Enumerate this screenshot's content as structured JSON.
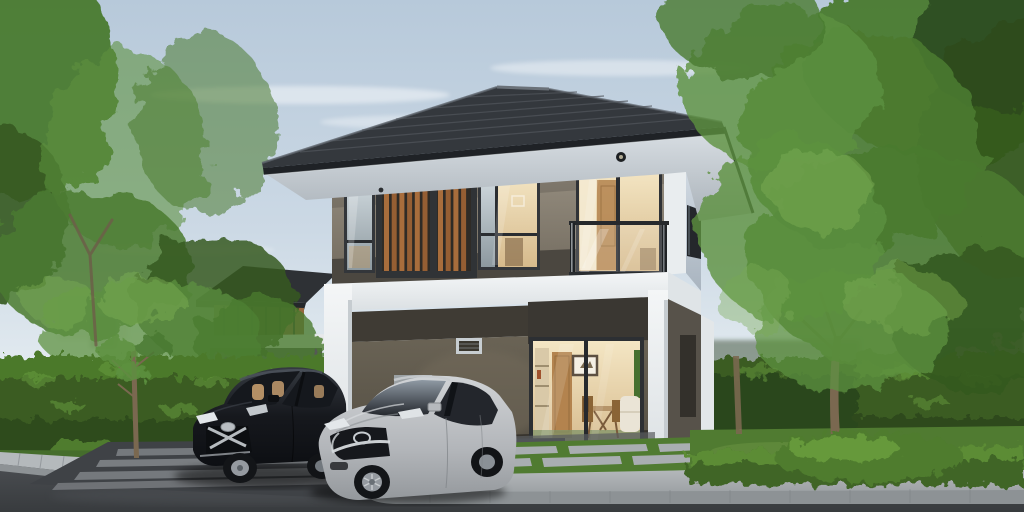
{
  "meta": {
    "kind": "architectural-exterior-render",
    "subject": "modern two-story detached house with carport, two parked cars, hedges, lawn and trees",
    "objects": [
      "sky",
      "clouds",
      "left-trees",
      "right-trees",
      "neighbor-house",
      "left-hedge",
      "right-hedge",
      "low-hedge",
      "lawn",
      "main-house",
      "hip-roof",
      "soffit-downlight",
      "wood-slat-panel",
      "balcony-glass-railing",
      "sliding-glass-door",
      "carport",
      "vent-window",
      "black-hatchback-car",
      "silver-sedan-car",
      "striped-driveway",
      "sidewalk",
      "curb",
      "road",
      "stepping-stones",
      "tree-trunks",
      "garden-bush"
    ]
  },
  "palette": {
    "sky_top": "#b7c9da",
    "sky_horizon": "#ecf1f4",
    "cloud": "#ffffff",
    "foliage": {
      "dark": "#2c4a1e",
      "deep": "#35591f",
      "mid": "#4a7a30",
      "light": "#5d9140",
      "bright": "#79ab52",
      "trunk": "#7a6850"
    },
    "hedge": {
      "base": "#3a5c23",
      "top": "#4f7c2e",
      "shadow": "#2c471c",
      "speckle": "#6ba03f",
      "low": "#3f6526",
      "low_top": "#5c8c35"
    },
    "lawn": {
      "base": "#507b31",
      "light": "#699442",
      "strip": "#456d2c"
    },
    "house": {
      "roof": "#34383d",
      "roof_line": "#50555b",
      "ridge": "#6a7178",
      "fascia": "#1f2226",
      "wall_top": "#948c7e",
      "wall_bottom": "#6f685c",
      "corner_white": "#e9edef",
      "band_dark": "#4b4740",
      "balcony_floor": "#3b3833",
      "frame": "#33363a",
      "frame_deep": "#2a2d31",
      "wood_a": "#a86d3c",
      "wood_b": "#955e33",
      "wood_gap": "#2f2b26",
      "white_hi": "#f4f6f7",
      "white_shade": "#c6ccd0",
      "ceiling": "#3f3b34",
      "carport_top": "#6b6456",
      "header": "#3a3732",
      "rail": "#26292c",
      "vent": "#c7cdd1",
      "cabinet": "#9ba1a4"
    },
    "interior": {
      "wall": "#ead9b4",
      "door": "#b3834e",
      "shelf": "#d9c9a8",
      "art": "#f4efe4",
      "table": "#b59469",
      "chair": "#8a6436",
      "sofa": "#eae4d6",
      "rug": "#7f9368",
      "plant": "#46702f"
    },
    "ground": {
      "driveway": "#3f4246",
      "stripe": "#888c90",
      "gravel": "#5a5d60",
      "curb": "#b4b9bc",
      "curb_face": "#8d9295",
      "stone": "#a9aeb1",
      "shadow": "#2c2a26"
    },
    "cars": {
      "black_body": "#0d0f13",
      "black_glass": "#15181d",
      "seat_tan": "#c49c6e",
      "chrome": "#c9ced3",
      "silver_glass": "#23262c",
      "grille_dark": "#16181c",
      "tire": "#131518",
      "rim": "#959aa0",
      "headlight": "#e3e7ea"
    },
    "neighbor": {
      "roof": "#2e3135",
      "wood": "#956740",
      "trim": "#e7e9eb",
      "dark": "#3c3f38"
    }
  }
}
